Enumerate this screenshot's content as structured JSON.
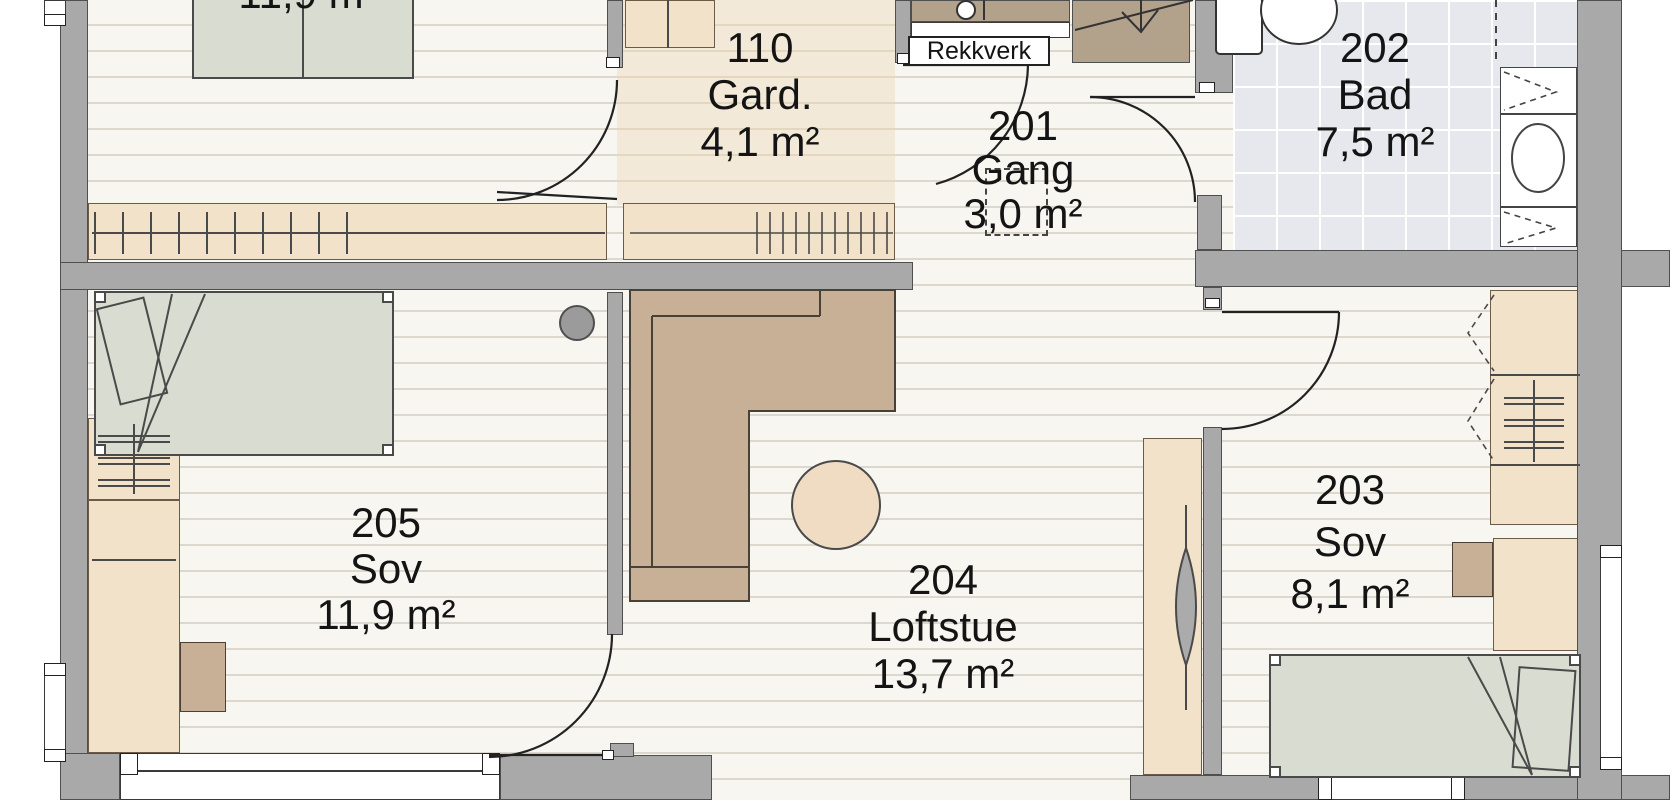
{
  "floorplan": {
    "rooms": [
      {
        "key": "room-110",
        "number": "110",
        "name": "Gard.",
        "area": "4,1 m²"
      },
      {
        "key": "room-201",
        "number": "201",
        "name": "Gang",
        "area": "3,0 m²"
      },
      {
        "key": "room-202",
        "number": "202",
        "name": "Bad",
        "area": "7,5 m²"
      },
      {
        "key": "room-203",
        "number": "203",
        "name": "Sov",
        "area": "8,1 m²"
      },
      {
        "key": "room-204",
        "number": "204",
        "name": "Loftstue",
        "area": "13,7 m²"
      },
      {
        "key": "room-205",
        "number": "205",
        "name": "Sov",
        "area": "11,9 m²"
      },
      {
        "key": "room-partial-top",
        "number": "",
        "name": "Sov",
        "area": "11,9 m²"
      }
    ],
    "labels": {
      "railing": "Rekkverk"
    },
    "colors": {
      "wall": "#a9a9a9",
      "floor_plank": "#f7f6f1",
      "floor_gard": "#f3e9d8",
      "tile": "#e6e8ee",
      "furniture_light": "#f3e2ca",
      "furniture_dark": "#c8b097",
      "bed": "#d9ddd1",
      "stair": "#b2a18b"
    }
  }
}
